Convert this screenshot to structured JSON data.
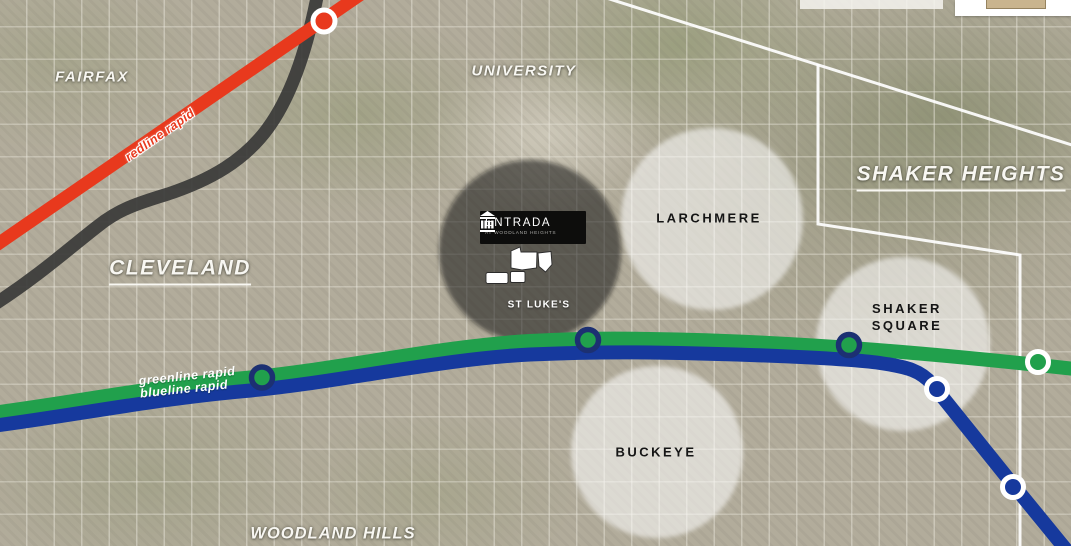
{
  "map": {
    "neighborhoods": {
      "fairfax": "FAIRFAX",
      "university": "UNIVERSITY",
      "cleveland": "CLEVELAND",
      "shaker_heights": "SHAKER HEIGHTS",
      "woodland_hills": "WOODLAND HILLS"
    },
    "areas": {
      "larchmere": "LARCHMERE",
      "shaker_square": "SHAKER SQUARE",
      "buckeye": "BUCKEYE"
    },
    "pois": {
      "st_lukes": "ST LUKE'S"
    },
    "transit": {
      "redline_label": "redline rapid",
      "greenline_label": "greenline rapid",
      "blueline_label": "blueline rapid"
    },
    "logo": {
      "title": "ENTRADA",
      "subtitle": "AT WOODLAND HEIGHTS"
    },
    "colors": {
      "redline": "#e8391d",
      "greenline": "#21a04c",
      "blueline": "#16399d",
      "rail_track": "#3a3a38",
      "station_ring_navy": "#1c3072",
      "station_ring_white": "#ffffff",
      "boundary_line": "#ffffff",
      "spotlight_dark": "rgba(15,15,12,0.55)",
      "highlight_white": "rgba(255,255,255,0.55)"
    }
  }
}
